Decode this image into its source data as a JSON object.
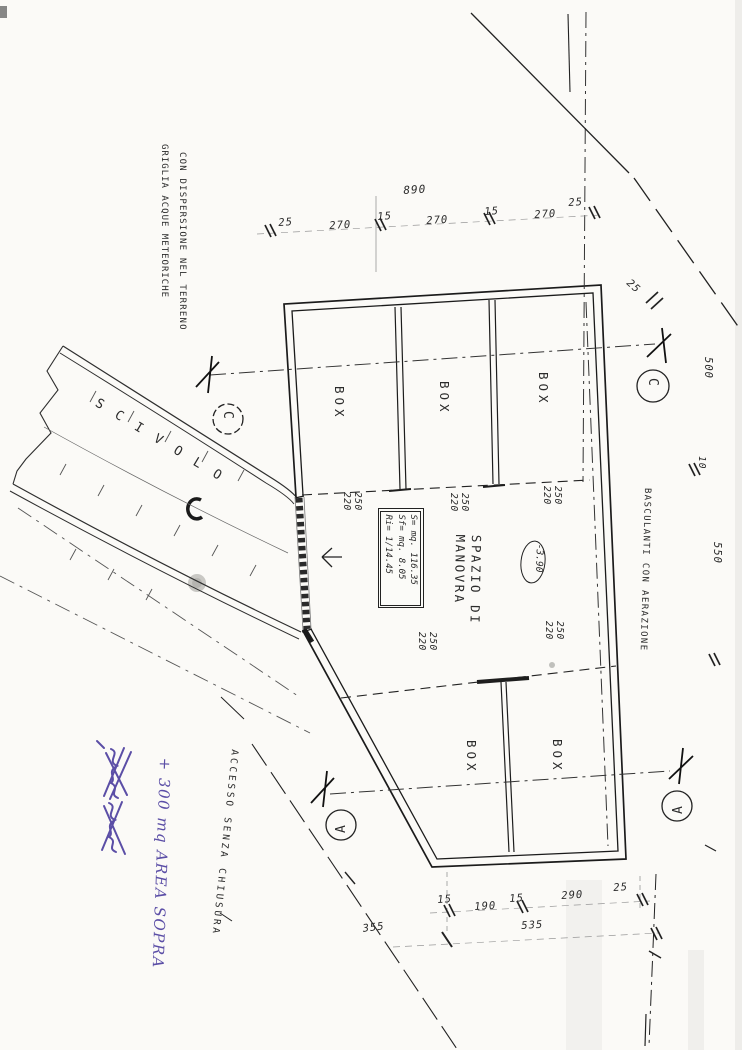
{
  "drawing": {
    "notes": {
      "griglia_line1": "GRIGLIA ACQUE METEORICHE",
      "griglia_line2": "CON DISPERSIONE NEL TERRENO",
      "scivolo": "SCIVOLO",
      "basculanti": "BASCULANTI CON AERAZIONE",
      "accesso": "ACCESSO SENZA CHIUSURA"
    },
    "handwritten": {
      "note": "+ 300 mq AREA SOPRA",
      "ink_color": "#5b4ea6"
    },
    "rooms": {
      "spazio_line1": "SPAZIO DI",
      "spazio_line2": "MANOVRA",
      "boxes": [
        "BOX",
        "BOX",
        "BOX",
        "BOX",
        "BOX"
      ],
      "quota": "-3.90"
    },
    "area_table": {
      "row_s": "S= mq. 116.35",
      "row_sf": "Sf= mq. 8.05",
      "row_ri": "Ri= 1/14.45"
    },
    "sections": {
      "c_left": "C",
      "c_right": "C",
      "a_left": "A",
      "a_right": "A"
    },
    "dimensions": {
      "top_total": "890",
      "top_row": [
        "25",
        "270",
        "15",
        "270",
        "15",
        "270",
        "25"
      ],
      "boundary_gap": "25",
      "right_depth_top": "500",
      "right_gap": "10",
      "right_depth_bottom": "550",
      "stall_pairs": [
        {
          "w": "250",
          "d": "220"
        },
        {
          "w": "250",
          "d": "220"
        },
        {
          "w": "250",
          "d": "220"
        },
        {
          "w": "250",
          "d": "220"
        },
        {
          "w": "250",
          "d": "220"
        }
      ],
      "bottom_row": [
        "15",
        "190",
        "15",
        "290",
        "25"
      ],
      "bottom_total": "535",
      "site_diagonal": "355"
    }
  }
}
